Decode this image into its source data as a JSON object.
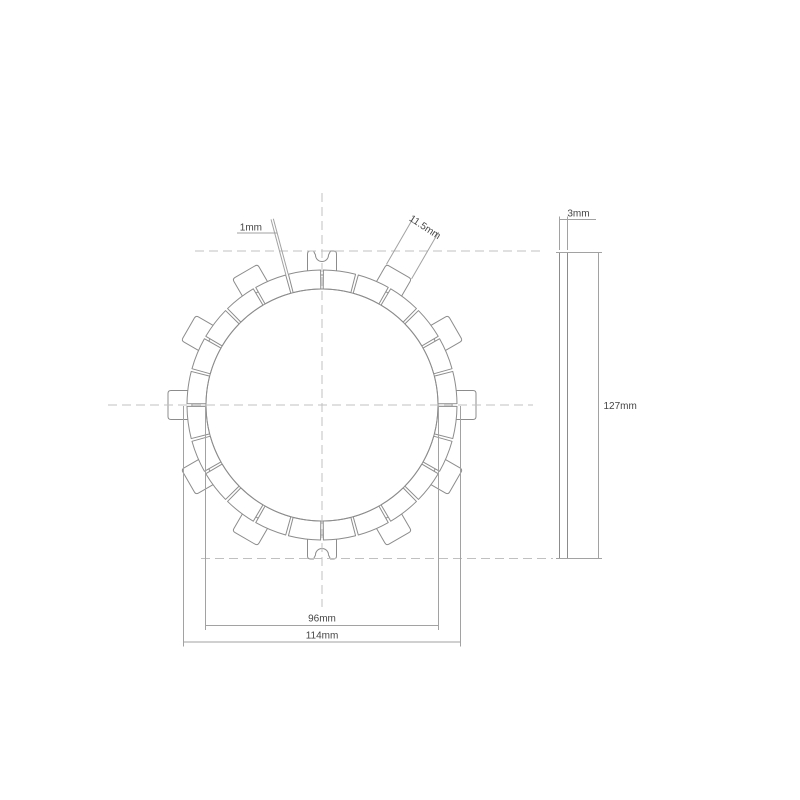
{
  "title": "Clutch friction plate technical drawing",
  "labels": {
    "groove_width": "1mm",
    "tab_width": "11.5mm",
    "thickness": "3mm",
    "overall_diameter": "127mm",
    "friction_inner_diameter": "96mm",
    "friction_outer_diameter": "114mm"
  },
  "colors": {
    "background": "#ffffff",
    "plate_stroke": "#8c8c8c",
    "dimension_stroke": "#a2a2a2",
    "centerline_stroke": "#c0c0c0",
    "text": "#454545"
  },
  "drawing": {
    "center": {
      "x": 322,
      "y": 405
    },
    "boreR": 116,
    "pads": {
      "count": 24,
      "innerR": 116,
      "outerR": 135,
      "pitchDeg": 15,
      "gapHalfDeg": 0.6
    },
    "tabs": {
      "angles": [
        0,
        30,
        60,
        90,
        120,
        150,
        180,
        210,
        240,
        270,
        300,
        330
      ],
      "notchedAngles": [
        90,
        270
      ],
      "halfWidth": 14.5,
      "innerR": 130,
      "outerR": 154,
      "cornerR": 3,
      "notch": {
        "mouthHalf": 8.5,
        "throatHalf": 6.5,
        "shoulderR": 150,
        "arcR": 6.5
      }
    },
    "leaders": {
      "groove": {
        "angle": 105,
        "halfGap": 1.2,
        "fromR": 135,
        "toR": 192.5
      },
      "tab": {
        "angle": 60,
        "off": 14.5,
        "fromR": 154,
        "toR": 208
      }
    }
  }
}
